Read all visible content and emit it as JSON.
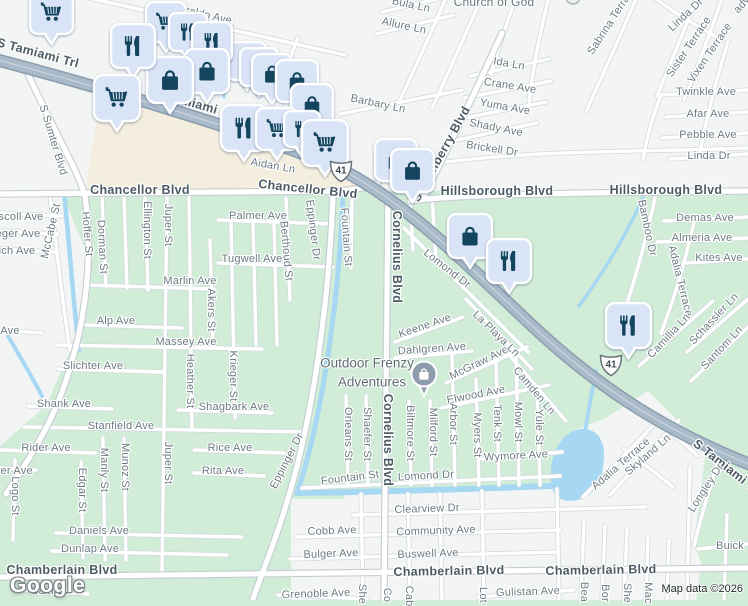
{
  "map": {
    "attribution": "Map data ©2026",
    "logo_text": "Google",
    "route_shield_label": "41",
    "poi_marker": {
      "line1": "Outdoor Frenzy",
      "line2": "Adventures"
    },
    "church_label": "Church of God",
    "colors": {
      "pin_fill": "#d9e4f6",
      "pin_icon": "#14455f",
      "poi_circle": "#8e9dab",
      "water": "#a6d8f3",
      "residential_green": "#d1ecd7",
      "surface_white": "#f3f5f4",
      "commercial_beige": "#f3eedd",
      "highway_fill": "#a9bac9",
      "major_label": "#4c5b64",
      "street_label": "#6d7a83"
    },
    "shields": [
      {
        "x": 341,
        "y": 170
      },
      {
        "x": 611,
        "y": 364
      }
    ],
    "pins": [
      {
        "t": "bag",
        "x": 247,
        "y": 42,
        "s": 38
      },
      {
        "t": "bag",
        "x": 259,
        "y": 48,
        "s": 38
      },
      {
        "t": "cart",
        "x": 166,
        "y": 2,
        "s": 40
      },
      {
        "t": "restaurant",
        "x": 188,
        "y": 13,
        "s": 38
      },
      {
        "t": "restaurant",
        "x": 212,
        "y": 22,
        "s": 40
      },
      {
        "t": "bag",
        "x": 272,
        "y": 54,
        "s": 40
      },
      {
        "t": "bag",
        "x": 297,
        "y": 60,
        "s": 42
      },
      {
        "t": "bag",
        "x": 207,
        "y": 49,
        "s": 44
      },
      {
        "t": "bag",
        "x": 170,
        "y": 57,
        "s": 46
      },
      {
        "t": "bag",
        "x": 312,
        "y": 84,
        "s": 42
      },
      {
        "t": "cart",
        "x": 51,
        "y": -9,
        "s": 43
      },
      {
        "t": "restaurant",
        "x": 133,
        "y": 24,
        "s": 44
      },
      {
        "t": "cart",
        "x": 117,
        "y": 75,
        "s": 46
      },
      {
        "t": "restaurant",
        "x": 244,
        "y": 105,
        "s": 46
      },
      {
        "t": "cart",
        "x": 277,
        "y": 108,
        "s": 42
      },
      {
        "t": "restaurant",
        "x": 302,
        "y": 111,
        "s": 36
      },
      {
        "t": "cart",
        "x": 325,
        "y": 120,
        "s": 46
      },
      {
        "t": "bag",
        "x": 396,
        "y": 139,
        "s": 42
      },
      {
        "t": "bag",
        "x": 412,
        "y": 149,
        "s": 43
      },
      {
        "t": "bag",
        "x": 470,
        "y": 214,
        "s": 44
      },
      {
        "t": "restaurant",
        "x": 509,
        "y": 239,
        "s": 44
      },
      {
        "t": "restaurant",
        "x": 628,
        "y": 303,
        "s": 45
      }
    ],
    "labels": [
      {
        "t": "S Tamiami Trl",
        "x": 38,
        "y": 53,
        "r": 15,
        "c": "maj"
      },
      {
        "t": "S Tamiami Trl",
        "x": 196,
        "y": 104,
        "r": 16,
        "c": "maj"
      },
      {
        "t": "Chancellor Blvd",
        "x": 140,
        "y": 190,
        "c": "maj"
      },
      {
        "t": "Chancellor Blvd",
        "x": 308,
        "y": 189,
        "r": 6,
        "c": "maj"
      },
      {
        "t": "Hillsborough Blvd",
        "x": 497,
        "y": 191,
        "c": "maj"
      },
      {
        "t": "Hillsborough Blvd",
        "x": 666,
        "y": 190,
        "c": "maj"
      },
      {
        "t": "Chamberlain Blvd",
        "x": 62,
        "y": 570,
        "c": "maj"
      },
      {
        "t": "Chamberlain Blvd",
        "x": 449,
        "y": 571,
        "r": -1,
        "c": "maj"
      },
      {
        "t": "Chamberlain Blvd",
        "x": 601,
        "y": 570,
        "r": -1,
        "c": "maj"
      },
      {
        "t": "Cornelius Blvd",
        "x": 397,
        "y": 257,
        "r": 90,
        "c": "maj"
      },
      {
        "t": "Cornelius Blvd",
        "x": 388,
        "y": 440,
        "r": 90,
        "c": "maj"
      },
      {
        "t": "S Cranberry Blvd",
        "x": 441,
        "y": 154,
        "r": -61,
        "c": "maj"
      },
      {
        "t": "S Tamiami Trl",
        "x": 728,
        "y": 468,
        "r": 38,
        "c": "maj"
      },
      {
        "t": "Maraldo Ave",
        "x": 201,
        "y": 14,
        "r": 13
      },
      {
        "t": "S Sumter Blvd",
        "x": 53,
        "y": 140,
        "r": 73
      },
      {
        "t": "Aidan Ln",
        "x": 273,
        "y": 166,
        "r": 10
      },
      {
        "t": "Barbary Ln",
        "x": 378,
        "y": 104,
        "r": 12
      },
      {
        "t": "Bula Ln",
        "x": 411,
        "y": 5,
        "r": 12
      },
      {
        "t": "Allure Ln",
        "x": 404,
        "y": 26,
        "r": 12
      },
      {
        "t": "Ida Ln",
        "x": 509,
        "y": 64,
        "r": 10
      },
      {
        "t": "Crane Ave",
        "x": 510,
        "y": 86,
        "r": 9
      },
      {
        "t": "Yuma Ave",
        "x": 505,
        "y": 107,
        "r": 10
      },
      {
        "t": "Shady Ave",
        "x": 496,
        "y": 128,
        "r": 11
      },
      {
        "t": "Brickell Dr",
        "x": 492,
        "y": 149,
        "r": 9
      },
      {
        "t": "Sabrina Terrace",
        "x": 612,
        "y": 20,
        "r": -57
      },
      {
        "t": "Linda Dr",
        "x": 686,
        "y": 15,
        "r": -43
      },
      {
        "t": "Sister Terrace",
        "x": 689,
        "y": 47,
        "r": -56
      },
      {
        "t": "Vixen Terrace",
        "x": 710,
        "y": 53,
        "r": -56
      },
      {
        "t": "Twinkle Ave",
        "x": 706,
        "y": 92
      },
      {
        "t": "Afar Ave",
        "x": 708,
        "y": 114
      },
      {
        "t": "Pebble Ave",
        "x": 708,
        "y": 135
      },
      {
        "t": "Linda Dr",
        "x": 709,
        "y": 156
      },
      {
        "t": "ady",
        "x": 742,
        "y": 5,
        "r": -48
      },
      {
        "t": "Church of God",
        "x": 494,
        "y": 2,
        "c": "poi2"
      },
      {
        "t": "scoll Ave",
        "x": 21,
        "y": 217
      },
      {
        "t": "eger Ave",
        "x": 18,
        "y": 234
      },
      {
        "t": "ich Ave",
        "x": 17,
        "y": 251
      },
      {
        "t": "McCabe St",
        "x": 51,
        "y": 231,
        "r": -77
      },
      {
        "t": "Hoffer St",
        "x": 87,
        "y": 234,
        "r": 85
      },
      {
        "t": "Dorman St",
        "x": 102,
        "y": 247,
        "r": 87
      },
      {
        "t": "Ellington St",
        "x": 147,
        "y": 230,
        "r": 90
      },
      {
        "t": "Juper St",
        "x": 168,
        "y": 225,
        "r": 90
      },
      {
        "t": "Palmer Ave",
        "x": 258,
        "y": 216
      },
      {
        "t": "Tugwell Ave",
        "x": 252,
        "y": 259
      },
      {
        "t": "Berthoud St",
        "x": 286,
        "y": 251,
        "r": 85
      },
      {
        "t": "Eppinger Dr",
        "x": 313,
        "y": 230,
        "r": 83
      },
      {
        "t": "Fountain St",
        "x": 346,
        "y": 237,
        "r": 86
      },
      {
        "t": "Marlin Ave",
        "x": 190,
        "y": 281
      },
      {
        "t": "Akers St",
        "x": 211,
        "y": 310,
        "r": 90
      },
      {
        "t": "Alp Ave",
        "x": 116,
        "y": 321
      },
      {
        "t": "Ave",
        "x": 10,
        "y": 331
      },
      {
        "t": "Massey Ave",
        "x": 186,
        "y": 342
      },
      {
        "t": "Slichter Ave",
        "x": 93,
        "y": 366
      },
      {
        "t": "Heather St",
        "x": 190,
        "y": 381,
        "r": 90
      },
      {
        "t": "Krieger St",
        "x": 233,
        "y": 376,
        "r": 90
      },
      {
        "t": "Shank Ave",
        "x": 64,
        "y": 404
      },
      {
        "t": "Shagbark Ave",
        "x": 234,
        "y": 407
      },
      {
        "t": "Stanfield Ave",
        "x": 121,
        "y": 426
      },
      {
        "t": "Rider Ave",
        "x": 46,
        "y": 448
      },
      {
        "t": "Rice Ave",
        "x": 230,
        "y": 448
      },
      {
        "t": "Rita Ave",
        "x": 223,
        "y": 471
      },
      {
        "t": "Manly St",
        "x": 104,
        "y": 470,
        "r": 90
      },
      {
        "t": "Munoz St",
        "x": 125,
        "y": 467,
        "r": 90
      },
      {
        "t": "Edgar St",
        "x": 82,
        "y": 490,
        "r": 90
      },
      {
        "t": "Juper St",
        "x": 168,
        "y": 463,
        "r": 90
      },
      {
        "t": "ter Ave",
        "x": 15,
        "y": 471
      },
      {
        "t": "Logo St",
        "x": 15,
        "y": 496,
        "r": 90
      },
      {
        "t": "Eppinger Dr",
        "x": 287,
        "y": 461,
        "r": -63
      },
      {
        "t": "Daniels Ave",
        "x": 99,
        "y": 531
      },
      {
        "t": "Dunlap Ave",
        "x": 90,
        "y": 549
      },
      {
        "t": "Cain Av",
        "x": 50,
        "y": 591
      },
      {
        "t": "Lomond Dr",
        "x": 447,
        "y": 269,
        "r": 38
      },
      {
        "t": "Keene Ave",
        "x": 425,
        "y": 326,
        "r": -19
      },
      {
        "t": "Dahlgren Ave",
        "x": 432,
        "y": 349,
        "r": -4
      },
      {
        "t": "McGraw Ave",
        "x": 479,
        "y": 363,
        "r": -26
      },
      {
        "t": "La Playa Ln",
        "x": 496,
        "y": 334,
        "r": 44
      },
      {
        "t": "Elwood Ave",
        "x": 476,
        "y": 395,
        "r": -11
      },
      {
        "t": "Camden Ln",
        "x": 534,
        "y": 391,
        "r": 50
      },
      {
        "t": "Orleans St",
        "x": 348,
        "y": 434,
        "r": 90
      },
      {
        "t": "Shaefer St",
        "x": 367,
        "y": 434,
        "r": 90
      },
      {
        "t": "Biltmore St",
        "x": 410,
        "y": 433,
        "r": 90
      },
      {
        "t": "Milford St",
        "x": 433,
        "y": 432,
        "r": 90
      },
      {
        "t": "Arbor St",
        "x": 453,
        "y": 424,
        "r": 90
      },
      {
        "t": "Myers St",
        "x": 477,
        "y": 435,
        "r": 90
      },
      {
        "t": "Tenk St",
        "x": 497,
        "y": 423,
        "r": 90
      },
      {
        "t": "Mowl St",
        "x": 518,
        "y": 422,
        "r": 90
      },
      {
        "t": "Yule St",
        "x": 539,
        "y": 427,
        "r": 90
      },
      {
        "t": "Wymore Ave",
        "x": 516,
        "y": 456,
        "r": -3
      },
      {
        "t": "Fountain St",
        "x": 350,
        "y": 478,
        "r": -7
      },
      {
        "t": "Lomond Dr",
        "x": 426,
        "y": 476,
        "r": -3
      },
      {
        "t": "Bamboo Dr",
        "x": 647,
        "y": 228,
        "r": 78
      },
      {
        "t": "Demas Ave",
        "x": 705,
        "y": 218
      },
      {
        "t": "Almeria Ave",
        "x": 702,
        "y": 238
      },
      {
        "t": "Kites Ave",
        "x": 719,
        "y": 258
      },
      {
        "t": "Adalia Terrace",
        "x": 680,
        "y": 281,
        "r": 76
      },
      {
        "t": "Schassler Ln",
        "x": 714,
        "y": 319,
        "r": -47
      },
      {
        "t": "Santom Ln",
        "x": 722,
        "y": 348,
        "r": -47
      },
      {
        "t": "Camillia Ln",
        "x": 669,
        "y": 336,
        "r": -47
      },
      {
        "t": "Skyland Ln",
        "x": 648,
        "y": 455,
        "r": -41
      },
      {
        "t": "Adalia Terrace",
        "x": 621,
        "y": 464,
        "r": -41
      },
      {
        "t": "Longley Dr",
        "x": 706,
        "y": 488,
        "r": -57
      },
      {
        "t": "Buick",
        "x": 730,
        "y": 546
      },
      {
        "t": "Clearview Dr",
        "x": 427,
        "y": 509,
        "r": -2
      },
      {
        "t": "Cobb Ave",
        "x": 332,
        "y": 531,
        "r": -2
      },
      {
        "t": "Community Ave",
        "x": 436,
        "y": 531,
        "r": -2
      },
      {
        "t": "Bulger Ave",
        "x": 331,
        "y": 554,
        "r": -2
      },
      {
        "t": "Buswell Ave",
        "x": 428,
        "y": 554,
        "r": -2
      },
      {
        "t": "Grenoble Ave",
        "x": 316,
        "y": 594,
        "r": -2
      },
      {
        "t": "Gulistan Ave",
        "x": 528,
        "y": 592,
        "r": -2
      },
      {
        "t": "She",
        "x": 362,
        "y": 594,
        "r": 90
      },
      {
        "t": "Co",
        "x": 387,
        "y": 595,
        "r": 90
      },
      {
        "t": "Cab",
        "x": 409,
        "y": 596,
        "r": 90
      },
      {
        "t": "Lot",
        "x": 483,
        "y": 595,
        "r": 90
      },
      {
        "t": "Bea",
        "x": 584,
        "y": 592,
        "r": 90
      },
      {
        "t": "Bor",
        "x": 605,
        "y": 593,
        "r": 90
      },
      {
        "t": "She",
        "x": 627,
        "y": 593,
        "r": 90
      },
      {
        "t": "Mac",
        "x": 648,
        "y": 593,
        "r": 90
      },
      {
        "t": "A",
        "x": 669,
        "y": 590,
        "r": 90
      }
    ]
  }
}
